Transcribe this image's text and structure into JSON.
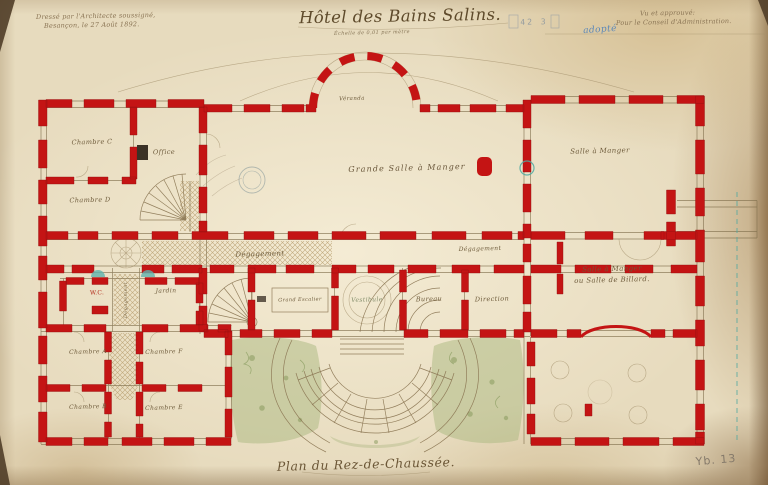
{
  "document": {
    "title": "Hôtel des Bains Salins.",
    "scale_note": "Échelle de 0,01 par mètre",
    "architect_note_line1": "Dressé par l'Architecte soussigné,",
    "architect_note_line2": "Besançon, le 27 Août 1892.",
    "approval_line1": "Vu et approuvé:",
    "approval_line2": "Pour le Conseil d'Administration.",
    "annotation_blue": "adopté",
    "stamp_text": "42 3",
    "footer_title": "Plan du Rez-de-Chaussée.",
    "reference_number": "Yb. 13"
  },
  "rooms": {
    "veranda": "Véranda",
    "grande_salle": "Grande Salle à Manger",
    "salle_a_manger": "Salle à Manger",
    "salle_billard_line1": "Salle à Manger",
    "salle_billard_line2": "ou Salle de Billard.",
    "chambre_c": "Chambre C",
    "office": "Office",
    "chambre_d": "Chambre D",
    "wc": "W.C.",
    "jardin": "Jardin",
    "degagement_main": "Dégagement",
    "degagement_right": "Dégagement",
    "degagement_vertical": "Dégagement",
    "grand_escalier": "Grand Escalier",
    "vestibule": "Vestibule",
    "bureau": "Bureau",
    "direction": "Direction",
    "chambre_a": "Chambre A",
    "chambre_f": "Chambre F",
    "chambre_b": "Chambre B",
    "chambre_e": "Chambre E"
  },
  "colors": {
    "wall_red": "#c41414",
    "paper": "#e7dbbe",
    "ink": "#7a6544",
    "accent_teal": "#4fa8a0",
    "garden_green": "#a9b780",
    "pencil_blue": "#5b87b8"
  }
}
